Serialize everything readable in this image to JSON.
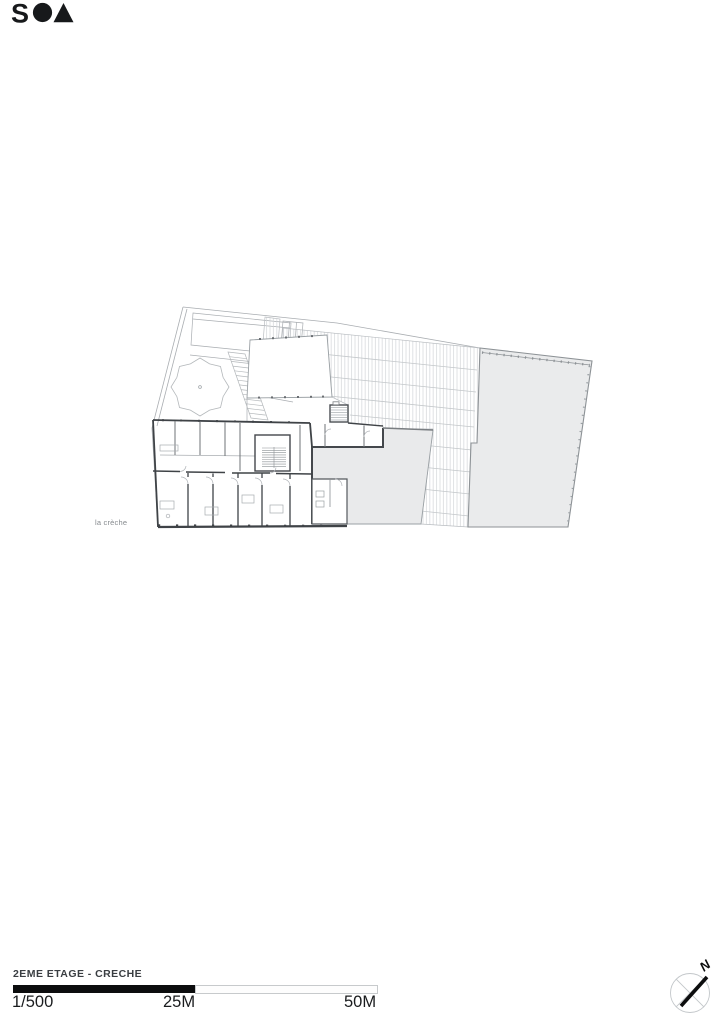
{
  "logo": {
    "letter": "S",
    "circle_icon": "filled-circle",
    "triangle_icon": "filled-triangle"
  },
  "plan": {
    "label": "la crèche"
  },
  "footer": {
    "title": "2EME ETAGE - CRECHE",
    "scale_start": "1/500",
    "scale_mid": "25M",
    "scale_end": "50M"
  },
  "north": {
    "label": "N"
  },
  "colors": {
    "ink": "#17191b",
    "wall_dark": "#3f4347",
    "line_light": "#a9adb1",
    "hatch": "#d2d5d8",
    "roof_fill": "#e9eaeb",
    "label_gray": "#85898d",
    "scalebar_black": "#0c0d0e"
  }
}
